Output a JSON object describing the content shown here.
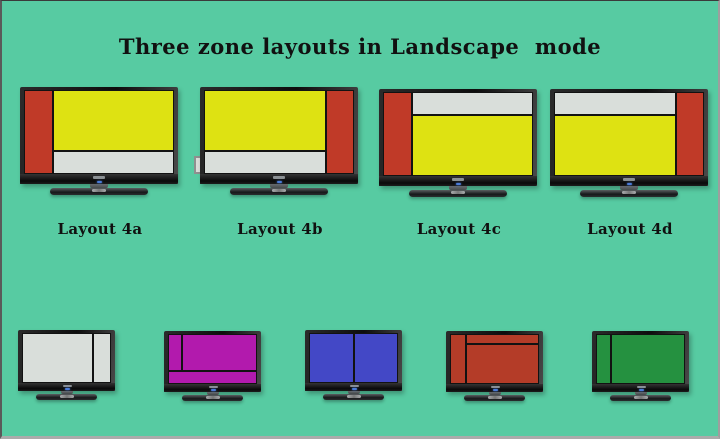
{
  "page": {
    "background": "#57CBA2",
    "title": "Three zone layouts in Landscape  mode",
    "title_color": "#111111",
    "border_bottom_color": "#ABABAB"
  },
  "tv_chrome": {
    "bezel_color": "#141414",
    "power_led_color": "#4A7BD8",
    "brand_logo": "tv-brand-logo"
  },
  "zone_colors": {
    "red": "#C03A28",
    "yellow": "#DEE212",
    "gray": "#D9DEDA",
    "magenta": "#B21AAD",
    "blue": "#4348C6",
    "brick": "#B43C28",
    "green": "#259140"
  },
  "tvs_top": [
    {
      "name": "layout-4a",
      "label": "Layout 4a",
      "zones": [
        {
          "name": "zone-red-left-strip",
          "color": "#C03A28",
          "x": 0,
          "y": 0,
          "w": 19,
          "h": 100
        },
        {
          "name": "zone-yellow-main",
          "color": "#DEE212",
          "x": 19,
          "y": 0,
          "w": 81,
          "h": 73
        },
        {
          "name": "zone-gray-bottom-strip",
          "color": "#D9DEDA",
          "x": 19,
          "y": 73,
          "w": 81,
          "h": 27
        }
      ]
    },
    {
      "name": "layout-4b",
      "label": "Layout 4b",
      "zones": [
        {
          "name": "zone-yellow-main",
          "color": "#DEE212",
          "x": 0,
          "y": 0,
          "w": 81,
          "h": 73
        },
        {
          "name": "zone-gray-bottom-strip",
          "color": "#D9DEDA",
          "x": 0,
          "y": 73,
          "w": 81,
          "h": 27
        },
        {
          "name": "zone-red-right-strip",
          "color": "#C03A28",
          "x": 81,
          "y": 0,
          "w": 19,
          "h": 100
        }
      ]
    },
    {
      "name": "layout-4c",
      "label": "Layout 4c",
      "zones": [
        {
          "name": "zone-red-left-strip",
          "color": "#C03A28",
          "x": 0,
          "y": 0,
          "w": 19,
          "h": 100
        },
        {
          "name": "zone-gray-top-strip",
          "color": "#D9DEDA",
          "x": 19,
          "y": 0,
          "w": 81,
          "h": 27
        },
        {
          "name": "zone-yellow-main",
          "color": "#DEE212",
          "x": 19,
          "y": 27,
          "w": 81,
          "h": 73
        }
      ]
    },
    {
      "name": "layout-4d",
      "label": "Layout 4d",
      "zones": [
        {
          "name": "zone-gray-top-strip",
          "color": "#D9DEDA",
          "x": 0,
          "y": 0,
          "w": 81,
          "h": 27
        },
        {
          "name": "zone-yellow-main",
          "color": "#DEE212",
          "x": 0,
          "y": 27,
          "w": 81,
          "h": 73
        },
        {
          "name": "zone-red-right-strip",
          "color": "#C03A28",
          "x": 81,
          "y": 0,
          "w": 19,
          "h": 100
        }
      ]
    }
  ],
  "tvs_bottom": [
    {
      "name": "thumb-gray-2zone",
      "zones": [
        {
          "name": "zone-main",
          "color": "#D9DEDA",
          "x": 0,
          "y": 0,
          "w": 80,
          "h": 100
        },
        {
          "name": "zone-right-strip",
          "color": "#D9DEDA",
          "x": 80,
          "y": 0,
          "w": 20,
          "h": 100
        }
      ]
    },
    {
      "name": "thumb-magenta-3zone",
      "zones": [
        {
          "name": "zone-left-strip",
          "color": "#B21AAD",
          "x": 0,
          "y": 0,
          "w": 16,
          "h": 73
        },
        {
          "name": "zone-main",
          "color": "#B21AAD",
          "x": 16,
          "y": 0,
          "w": 84,
          "h": 73
        },
        {
          "name": "zone-bottom-strip",
          "color": "#B21AAD",
          "x": 0,
          "y": 73,
          "w": 100,
          "h": 27
        }
      ]
    },
    {
      "name": "thumb-blue-2zone",
      "zones": [
        {
          "name": "zone-left-half",
          "color": "#4348C6",
          "x": 0,
          "y": 0,
          "w": 50,
          "h": 100
        },
        {
          "name": "zone-right-half",
          "color": "#4348C6",
          "x": 50,
          "y": 0,
          "w": 50,
          "h": 100
        }
      ]
    },
    {
      "name": "thumb-red-3zone",
      "zones": [
        {
          "name": "zone-left-strip",
          "color": "#B43C28",
          "x": 0,
          "y": 0,
          "w": 18,
          "h": 100
        },
        {
          "name": "zone-top-strip",
          "color": "#B43C28",
          "x": 18,
          "y": 0,
          "w": 82,
          "h": 20
        },
        {
          "name": "zone-main",
          "color": "#B43C28",
          "x": 18,
          "y": 20,
          "w": 82,
          "h": 80
        }
      ]
    },
    {
      "name": "thumb-green-2zone",
      "zones": [
        {
          "name": "zone-left-strip",
          "color": "#259140",
          "x": 0,
          "y": 0,
          "w": 17,
          "h": 100
        },
        {
          "name": "zone-main",
          "color": "#259140",
          "x": 17,
          "y": 0,
          "w": 83,
          "h": 100
        }
      ]
    }
  ]
}
